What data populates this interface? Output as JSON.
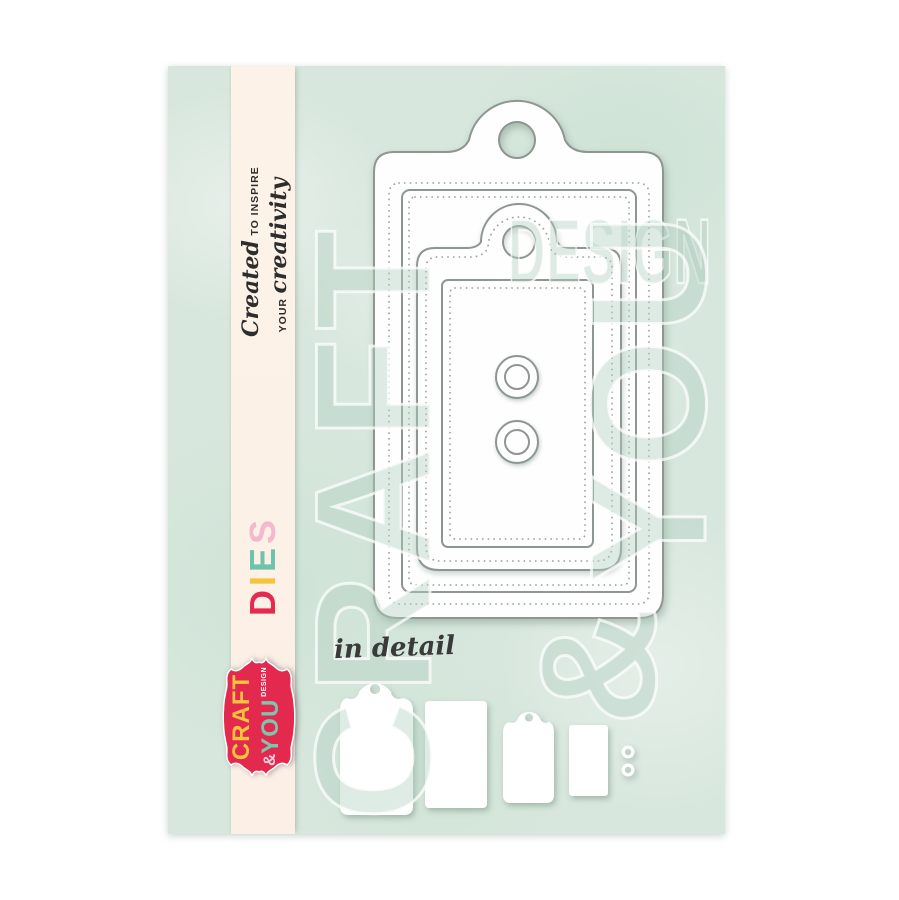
{
  "page": {
    "background": "#ffffff"
  },
  "card": {
    "background": "#d8e7dd",
    "ribbon_color": "#fdf2e8"
  },
  "ribbon": {
    "tagline_line1_script": "Created",
    "tagline_line1_caps": "TO INSPIRE",
    "tagline_line2_caps": "YOUR",
    "tagline_line2_script": "creativity",
    "dies_letters": [
      {
        "char": "D",
        "color": "#e62a4f"
      },
      {
        "char": "I",
        "color": "#f4c53b"
      },
      {
        "char": "E",
        "color": "#6fc2ab"
      },
      {
        "char": "S",
        "color": "#f5b8ce"
      }
    ]
  },
  "logo": {
    "craft": "CRAFT",
    "ampersand": "&",
    "you": "YOU",
    "design": "DESIGN",
    "badge_red": "#e4294e",
    "craft_color": "#f4c53b",
    "you_color": "#7cc5ae",
    "ampersand_color": "#f7cfe0"
  },
  "watermark": {
    "design": "DESIGN",
    "craft": "CRAFT",
    "you": "YOU",
    "ampersand": "&"
  },
  "detail": {
    "label": "in detail"
  }
}
